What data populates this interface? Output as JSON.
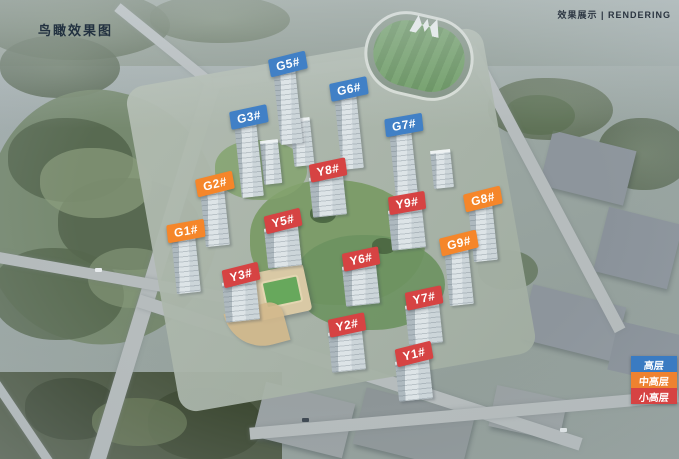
{
  "header": {
    "title": "鸟瞰效果图",
    "caption": "效果展示 | RENDERING"
  },
  "tier_colors": {
    "high": "#4180c6",
    "mid_high": "#f5862a",
    "small_high": "#d64343"
  },
  "legend": {
    "items": [
      {
        "label": "高层",
        "tier": "high",
        "color": "#3a7bc2"
      },
      {
        "label": "中高层",
        "tier": "mid_high",
        "color": "#ee8230"
      },
      {
        "label": "小高层",
        "tier": "small_high",
        "color": "#d64343"
      }
    ]
  },
  "buildings": [
    {
      "label": "G5#",
      "tier": "high",
      "x": 288,
      "y": 64,
      "rot": -14
    },
    {
      "label": "G6#",
      "tier": "high",
      "x": 349,
      "y": 89,
      "rot": -12
    },
    {
      "label": "G3#",
      "tier": "high",
      "x": 249,
      "y": 117,
      "rot": -12
    },
    {
      "label": "G7#",
      "tier": "high",
      "x": 404,
      "y": 125,
      "rot": -10
    },
    {
      "label": "G2#",
      "tier": "mid_high",
      "x": 215,
      "y": 184,
      "rot": -14
    },
    {
      "label": "G8#",
      "tier": "mid_high",
      "x": 483,
      "y": 199,
      "rot": -14
    },
    {
      "label": "G1#",
      "tier": "mid_high",
      "x": 186,
      "y": 231,
      "rot": -10
    },
    {
      "label": "G9#",
      "tier": "mid_high",
      "x": 459,
      "y": 243,
      "rot": -14
    },
    {
      "label": "Y8#",
      "tier": "small_high",
      "x": 328,
      "y": 170,
      "rot": -12
    },
    {
      "label": "Y9#",
      "tier": "small_high",
      "x": 407,
      "y": 203,
      "rot": -10
    },
    {
      "label": "Y5#",
      "tier": "small_high",
      "x": 283,
      "y": 221,
      "rot": -14
    },
    {
      "label": "Y6#",
      "tier": "small_high",
      "x": 361,
      "y": 259,
      "rot": -12
    },
    {
      "label": "Y3#",
      "tier": "small_high",
      "x": 241,
      "y": 275,
      "rot": -14
    },
    {
      "label": "Y7#",
      "tier": "small_high",
      "x": 424,
      "y": 298,
      "rot": -12
    },
    {
      "label": "Y2#",
      "tier": "small_high",
      "x": 347,
      "y": 325,
      "rot": -12
    },
    {
      "label": "Y1#",
      "tier": "small_high",
      "x": 414,
      "y": 354,
      "rot": -14
    }
  ]
}
